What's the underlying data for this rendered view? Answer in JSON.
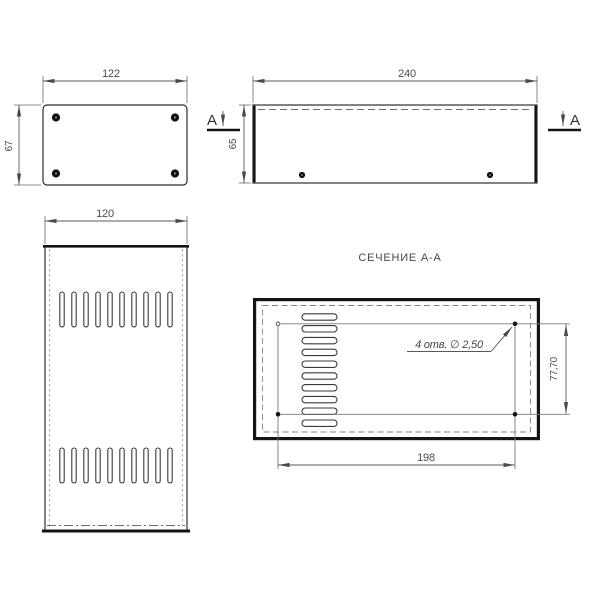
{
  "drawing": {
    "type": "technical-drawing",
    "background": "#ffffff",
    "line_color": "#2e2e2e",
    "dim_color": "#5a5a5a",
    "top_view": {
      "width_dim": "122",
      "height_dim": "67",
      "corner_screws": 4
    },
    "side_view": {
      "width_dim": "240",
      "height_dim": "65",
      "section_mark_left": "A",
      "section_mark_right": "A"
    },
    "front_view": {
      "width_dim": "120",
      "vent_slots_per_row": 10,
      "vent_rows": 2
    },
    "section_view": {
      "title": "СЕЧЕНИЕ А-А",
      "holes_note": "4 отв. ∅ 2,50",
      "height_dim": "77,70",
      "width_dim": "198",
      "vent_slots": 10
    }
  }
}
